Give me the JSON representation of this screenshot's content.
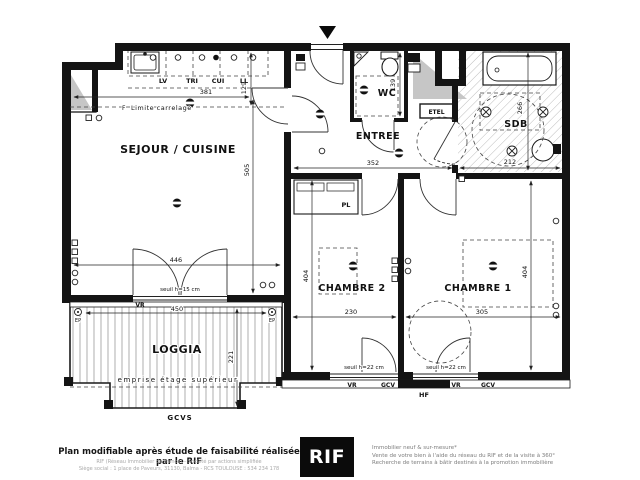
{
  "plan": {
    "rooms": {
      "sejour": "SEJOUR / CUISINE",
      "entree": "ENTREE",
      "wc": "WC",
      "sdb": "SDB",
      "chambre2": "CHAMBRE 2",
      "chambre1": "CHAMBRE 1",
      "loggia": "LOGGIA",
      "placard": "PL",
      "etel": "ETEL"
    },
    "kitchen": {
      "lv": "LV",
      "tri": "TRI",
      "cui": "CUI",
      "ll": "LL"
    },
    "dims": {
      "d381": "381",
      "d129": "129",
      "d505": "505",
      "d352": "352",
      "d139": "139",
      "d266": "266",
      "d212": "212",
      "d404a": "404",
      "d404b": "404",
      "d230": "230",
      "d305": "305",
      "d446": "446",
      "d450": "450",
      "d221": "221"
    },
    "annotations": {
      "f_mark": "F",
      "limite": "Limite carrelage",
      "seuil15": "seuil h=15 cm",
      "seuil22a": "seuil h=22 cm",
      "seuil22b": "seuil h=22 cm",
      "vr_sejour": "VR",
      "vr_ch2": "VR",
      "gcv_ch2": "GCV",
      "vr_ch1": "VR",
      "gcv_ch1": "GCV",
      "hf": "HF",
      "gcvs": "GCVS",
      "ep_left": "EP",
      "ep_right": "EP",
      "emprise": "emprise étage supérieur"
    }
  },
  "footer": {
    "left_bold": "Plan modifiable après étude de faisabilité réalisée par le RIF",
    "left_line1": "RIF (Réseau Immobilier de France) – Société par actions simplifiée",
    "left_line2": "Siège social : 1 place de Paveurs, 31130, Balma - RCS TOULOUSE : 534 234 178",
    "logo": "RIF",
    "right_line1": "Immobilier neuf & sur-mesure*",
    "right_line2": "Vente de votre bien à l'aide du réseau du RIF et de la visite à 360°",
    "right_line3": "Recherche de terrains à bâtir destinés à la promotion immobilière"
  }
}
